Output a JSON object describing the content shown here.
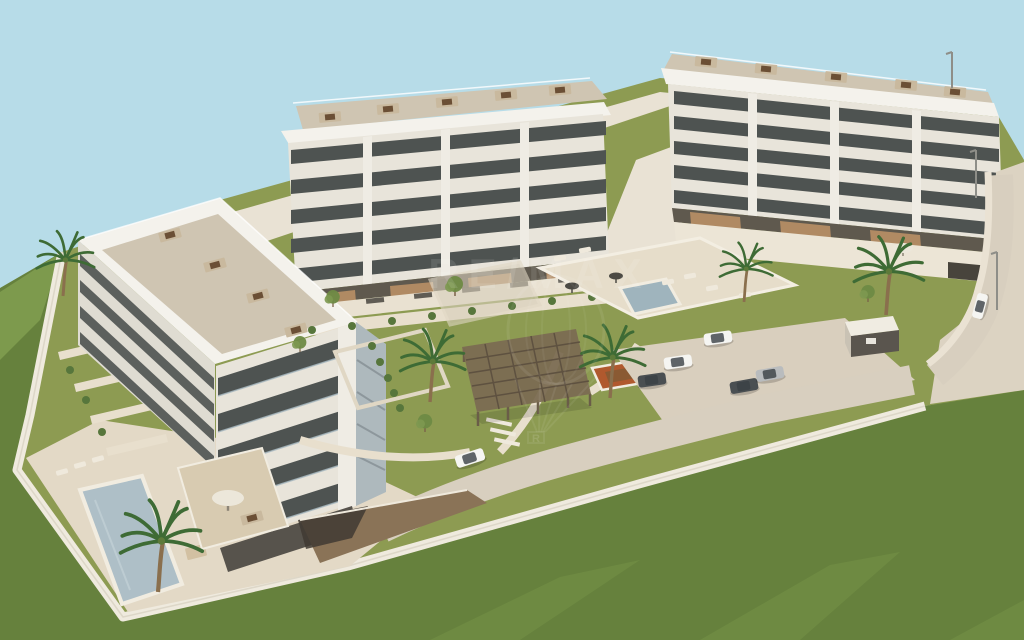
{
  "watermark": {
    "text": "RE/MAX",
    "registered": "R"
  },
  "colors": {
    "sky": "#b7dce8",
    "lawnIn": "#8d9b52",
    "lawnOut": "#66813d",
    "lawnHill": "#7d9a4d",
    "lawnStripe": "#759247",
    "deck": "#e3d9c6",
    "path": "#e8dfcd",
    "plaza": "#e9e2d4",
    "road": "#d8cfbf",
    "pad": "#d9cfbe",
    "sidewalk": "#eae2d3",
    "wall": "#efeade",
    "roofWhite": "#f4f2ec",
    "roofTerrace": "#cfc5b2",
    "facade": "#e8e4da",
    "facadeShade": "#dfdcd2",
    "windowDark": "#4e5351",
    "pier": "#efece4",
    "groundDark": "#5f594e",
    "baseWall": "#e9e1d1",
    "woodDeck": "#b08a63",
    "podium": "#ece5d6",
    "garageDark": "#48443c",
    "ramp": "#8a7357",
    "pool": "#aebfc7",
    "poolDeep": "#9fb4bd",
    "pergola": "#7b6b52",
    "pergolaSlat": "#5e5140",
    "terracotta": "#b0592e",
    "bench": "#8a5a33",
    "palmLeaf": "#3e6b35",
    "palmTrunk": "#8a6f4d",
    "bush": "#57763c",
    "treeOlive": "#6e8a44",
    "carWhite": "#f5f5f2",
    "carDark": "#4a4f52",
    "carSilver": "#b9bcbe",
    "utilRoof": "#f0ece2",
    "utilFront": "#5a554e",
    "lamp": "#8e8e88",
    "sideTint": "#aeb9bd",
    "glassTint": "#a9bac2",
    "watermark": "#ffffff"
  }
}
